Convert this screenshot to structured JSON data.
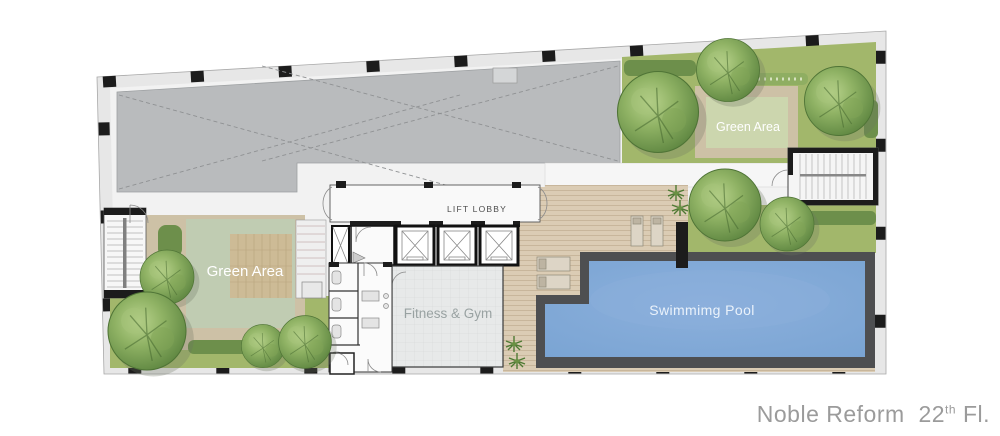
{
  "plan": {
    "labels": {
      "lift_lobby": "LIFT LOBBY",
      "green_area_left": "Green Area",
      "green_area_right": "Green Area",
      "fitness_gym": "Fitness & Gym",
      "swimming_pool": "Swimmimg Pool"
    }
  },
  "title": {
    "project": "Noble Reform",
    "floor_number": "22",
    "floor_ordinal": "th",
    "floor_word": "Fl."
  },
  "colors": {
    "wall_black": "#1c1c1c",
    "wall_light": "#e7e7e7",
    "floor_base": "#f2f2f2",
    "void_gray": "#b9bbbd",
    "grass": "#a2b76b",
    "sage": "#c0ccb2",
    "sage_light": "#ccd6ae",
    "path_tan": "#cdc1a6",
    "wood": "#cdbb96",
    "deck": "#dbccb4",
    "deck_line": "#c8b69b",
    "pool_rim": "#4e4f51",
    "pool_water": "#7fa9d8",
    "hedge": "#6d8f4b",
    "tree_dark": "#5d8540",
    "tree_mid": "#8fb264",
    "tree_light": "#b9d38d",
    "gym_floor": "#e7e9e9",
    "label_gray": "#99a2a2",
    "title_gray": "#9b9b9b"
  }
}
